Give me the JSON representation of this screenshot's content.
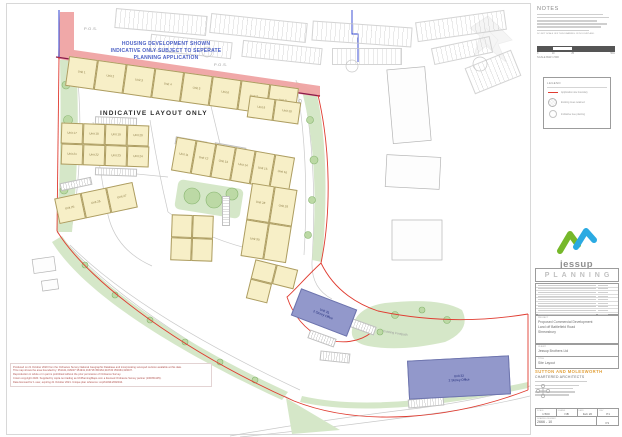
{
  "plan": {
    "pos_labels": [
      "P.O.S.",
      "P.O.S."
    ],
    "notice": {
      "lines": [
        "HOUSING DEVELOPMENT SHOWN",
        "INDICATIVE ONLY SUBJECT TO SEPERATE",
        "PLANNING APPLICATION"
      ]
    },
    "indicative_label": "INDICATIVE LAYOUT ONLY",
    "footpath_label": "Existing Footpath",
    "unit_groups": [
      {
        "x": 66,
        "y": 72,
        "w": 232,
        "h": 30,
        "rot": 8,
        "cols": 8,
        "units": [
          "Unit 1",
          "Unit 2",
          "Unit 3",
          "Unit 4",
          "Unit 5",
          "Unit 6",
          "Unit 7",
          "Unit 8"
        ]
      },
      {
        "x": 248,
        "y": 99,
        "w": 52,
        "h": 22,
        "rot": 8,
        "cols": 2,
        "units": [
          "Unit 9",
          "Unit 10"
        ]
      },
      {
        "x": 173,
        "y": 147,
        "w": 120,
        "h": 34,
        "rot": 10,
        "cols": 6,
        "units": [
          "Unit 11",
          "Unit 12",
          "Unit 13",
          "Unit 14",
          "Unit 15",
          "Unit 16"
        ]
      },
      {
        "x": 61,
        "y": 124,
        "w": 88,
        "h": 21,
        "rot": 2,
        "cols": 4,
        "units": [
          "Unit 17",
          "Unit 18",
          "Unit 19",
          "Unit 20"
        ]
      },
      {
        "x": 61,
        "y": 145,
        "w": 88,
        "h": 21,
        "rot": 2,
        "cols": 4,
        "units": [
          "Unit 21",
          "Unit 22",
          "Unit 23",
          "Unit 24"
        ]
      },
      {
        "x": 56,
        "y": 190,
        "w": 80,
        "h": 26,
        "rot": -12,
        "cols": 3,
        "units": [
          "Unit 25",
          "Unit 26",
          "Unit 27"
        ]
      },
      {
        "x": 246,
        "y": 186,
        "w": 46,
        "h": 74,
        "rot": 9,
        "cols": 2,
        "units": [
          "Unit 28",
          "Unit 29",
          "Unit 30",
          ""
        ]
      },
      {
        "x": 171,
        "y": 215,
        "w": 42,
        "h": 46,
        "rot": 2,
        "cols": 2,
        "units": [
          "",
          "",
          "",
          ""
        ]
      },
      {
        "x": 250,
        "y": 264,
        "w": 44,
        "h": 40,
        "rot": 14,
        "cols": 2,
        "units": [
          "",
          "",
          ""
        ]
      }
    ],
    "offices": [
      {
        "x": 294,
        "y": 298,
        "w": 58,
        "h": 27,
        "rot": 21,
        "lines": [
          "Unit 31",
          "2 Storey Office"
        ]
      },
      {
        "x": 408,
        "y": 358,
        "w": 100,
        "h": 37,
        "rot": -3,
        "lines": [
          "Unit 32",
          "2 Storey Office"
        ]
      }
    ],
    "disclaimer_lines": [
      "Produced on 21 October 2020 from the Ordnance Survey National Geographic Database and incorporating surveyed revision available at this date.",
      "This map shows the area bounded by: 351441,316037 351941,316718 351964,316720 351964,316037.",
      "Reproduction in whole or in part is prohibited without the prior permission of Ordnance Survey.",
      "Crown copyright 2020. Supplied by copla.net trading as UKPlanningMaps.com a licensed Ordnance Survey partner (100054135).",
      "Data licensed for 1 user, expiring 21 October 2021. Unique plan reference: cop/614941/692344."
    ]
  },
  "titleblock": {
    "notes_title": "NOTES",
    "do_not_scale": "DO NOT SCALE OFF THIS DRAWING. IF IN DOUBT ASK.",
    "scale_bar": {
      "numbers": [
        "0",
        "10",
        "25",
        "50m"
      ],
      "caption": "SCALE BAR 1:500"
    },
    "legend": {
      "title": "LEGEND",
      "items": [
        {
          "symbol": "boundary-line",
          "label": "Application site boundary"
        },
        {
          "symbol": "existing-tree",
          "label": "Existing trees retained"
        },
        {
          "symbol": "proposed-tree",
          "label": "Indicative tree planting"
        }
      ]
    },
    "logo": {
      "name": "jessup"
    },
    "planning_label": "PLANNING",
    "project": {
      "label": "PROJECT",
      "lines": [
        "Proposed Commercial Development",
        "Land off Battlefield Road",
        "Shrewsbury"
      ]
    },
    "client": {
      "label": "CLIENT",
      "value": "Jessup Brothers Ltd"
    },
    "drawing_title": {
      "label": "TITLE",
      "value": "Site Layout"
    },
    "architects": {
      "firm": "SUTTON AND MOLESWORTH",
      "type": "CHARTERED ARCHITECTS"
    },
    "drawing_table": {
      "headers": [
        "SCALE",
        "DRAWN",
        "DATE",
        "REV"
      ],
      "values": [
        "1:500",
        "NB",
        "Feb 20",
        "P1"
      ],
      "number_label": "DRAWING NUMBER",
      "number": "2666 - 10",
      "rev": "P1"
    }
  },
  "colors": {
    "pink_band": "#efa3a3",
    "maroon_edge": "#8b1a4a",
    "boundary_red": "#e03c31",
    "boundary_blue": "#2b3fd0",
    "unit_yellow": "#f7efc7",
    "landscape_green": "#d5e7c8",
    "office_purple": "#9298cb",
    "logo_green": "#76b82a",
    "logo_blue": "#2baae2",
    "architects_orange": "#e2a13c"
  }
}
